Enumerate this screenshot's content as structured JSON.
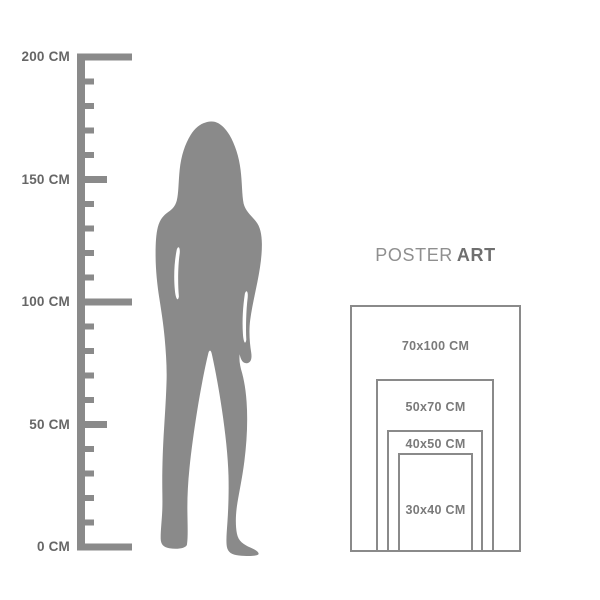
{
  "colors": {
    "background": "#ffffff",
    "line_gray": "#8a8a8a",
    "silhouette_gray": "#8a8a8a",
    "label_gray": "#666666",
    "size_label_gray": "#7a7a7a",
    "brand_regular_gray": "#8f8f8f",
    "brand_bold_gray": "#6f6f6f"
  },
  "ruler": {
    "unit": "CM",
    "labels": [
      {
        "value": "200 CM"
      },
      {
        "value": "150 CM"
      },
      {
        "value": "100 CM"
      },
      {
        "value": "50 CM"
      },
      {
        "value": "0 CM"
      }
    ]
  },
  "figure": {
    "silhouette": "standing-woman"
  },
  "brand": {
    "regular": "POSTER",
    "bold": "ART"
  },
  "poster_sizes": [
    {
      "label": "70x100 CM"
    },
    {
      "label": "50x70 CM"
    },
    {
      "label": "40x50 CM"
    },
    {
      "label": "30x40 CM"
    }
  ]
}
